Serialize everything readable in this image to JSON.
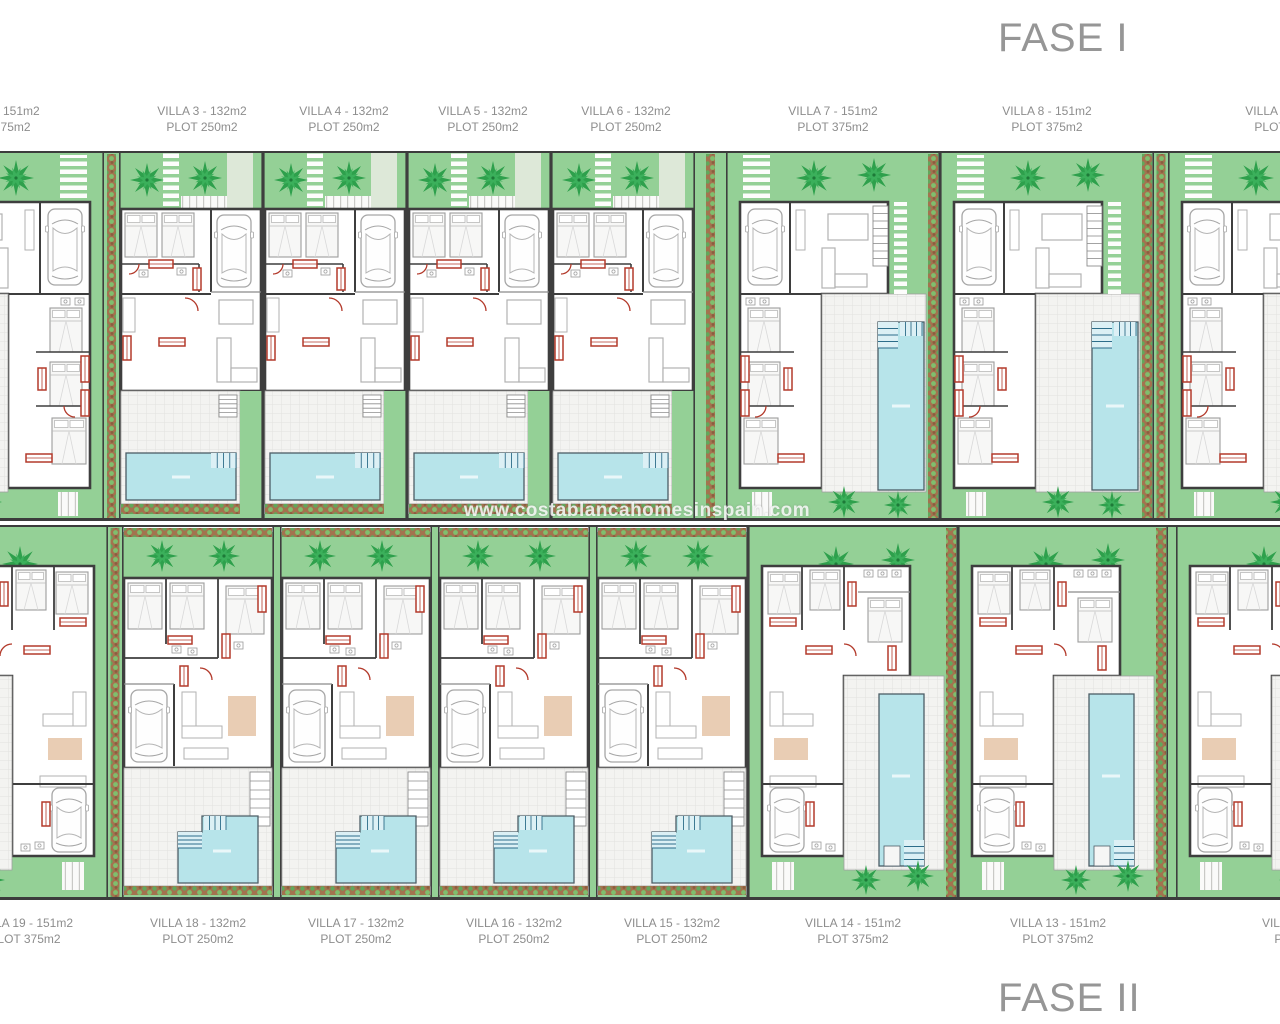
{
  "page": {
    "watermark": "www.costablancahomesinspain.com",
    "background": "#ffffff"
  },
  "phase1": {
    "title": "FASE I",
    "villas": [
      {
        "name": "villa-2",
        "line1": "VILLA 2 - 151m2",
        "line2": "PLOT 375m2"
      },
      {
        "name": "villa-3",
        "line1": "VILLA 3 - 132m2",
        "line2": "PLOT 250m2"
      },
      {
        "name": "villa-4",
        "line1": "VILLA 4 - 132m2",
        "line2": "PLOT 250m2"
      },
      {
        "name": "villa-5",
        "line1": "VILLA 5 - 132m2",
        "line2": "PLOT 250m2"
      },
      {
        "name": "villa-6",
        "line1": "VILLA 6 - 132m2",
        "line2": "PLOT 250m2"
      },
      {
        "name": "villa-7",
        "line1": "VILLA 7 - 151m2",
        "line2": "PLOT 375m2"
      },
      {
        "name": "villa-8",
        "line1": "VILLA 8 - 151m2",
        "line2": "PLOT 375m2"
      },
      {
        "name": "villa-9",
        "line1": "VILLA 9 - 151m2",
        "line2": "PLOT 375m2"
      }
    ]
  },
  "phase2": {
    "title": "FASE II",
    "villas": [
      {
        "name": "villa-19",
        "line1": "VILLA 19 - 151m2",
        "line2": "PLOT 375m2"
      },
      {
        "name": "villa-18",
        "line1": "VILLA 18 - 132m2",
        "line2": "PLOT 250m2"
      },
      {
        "name": "villa-17",
        "line1": "VILLA 17 - 132m2",
        "line2": "PLOT 250m2"
      },
      {
        "name": "villa-16",
        "line1": "VILLA 16 - 132m2",
        "line2": "PLOT 250m2"
      },
      {
        "name": "villa-15",
        "line1": "VILLA 15 - 132m2",
        "line2": "PLOT 250m2"
      },
      {
        "name": "villa-14",
        "line1": "VILLA 14 - 151m2",
        "line2": "PLOT 375m2"
      },
      {
        "name": "villa-13",
        "line1": "VILLA 13 - 151m2",
        "line2": "PLOT 375m2"
      },
      {
        "name": "villa-12",
        "line1": "VILLA 12 - 151m2",
        "line2": "PLOT 375m2"
      }
    ]
  },
  "colors": {
    "garden_green": "#94d096",
    "palm_green": "#2ea04c",
    "pool_blue": "#b7e4ea",
    "accent_red": "#b33a2b",
    "wall_gray": "#3e3e3e",
    "label_gray": "#8d8d8d"
  }
}
